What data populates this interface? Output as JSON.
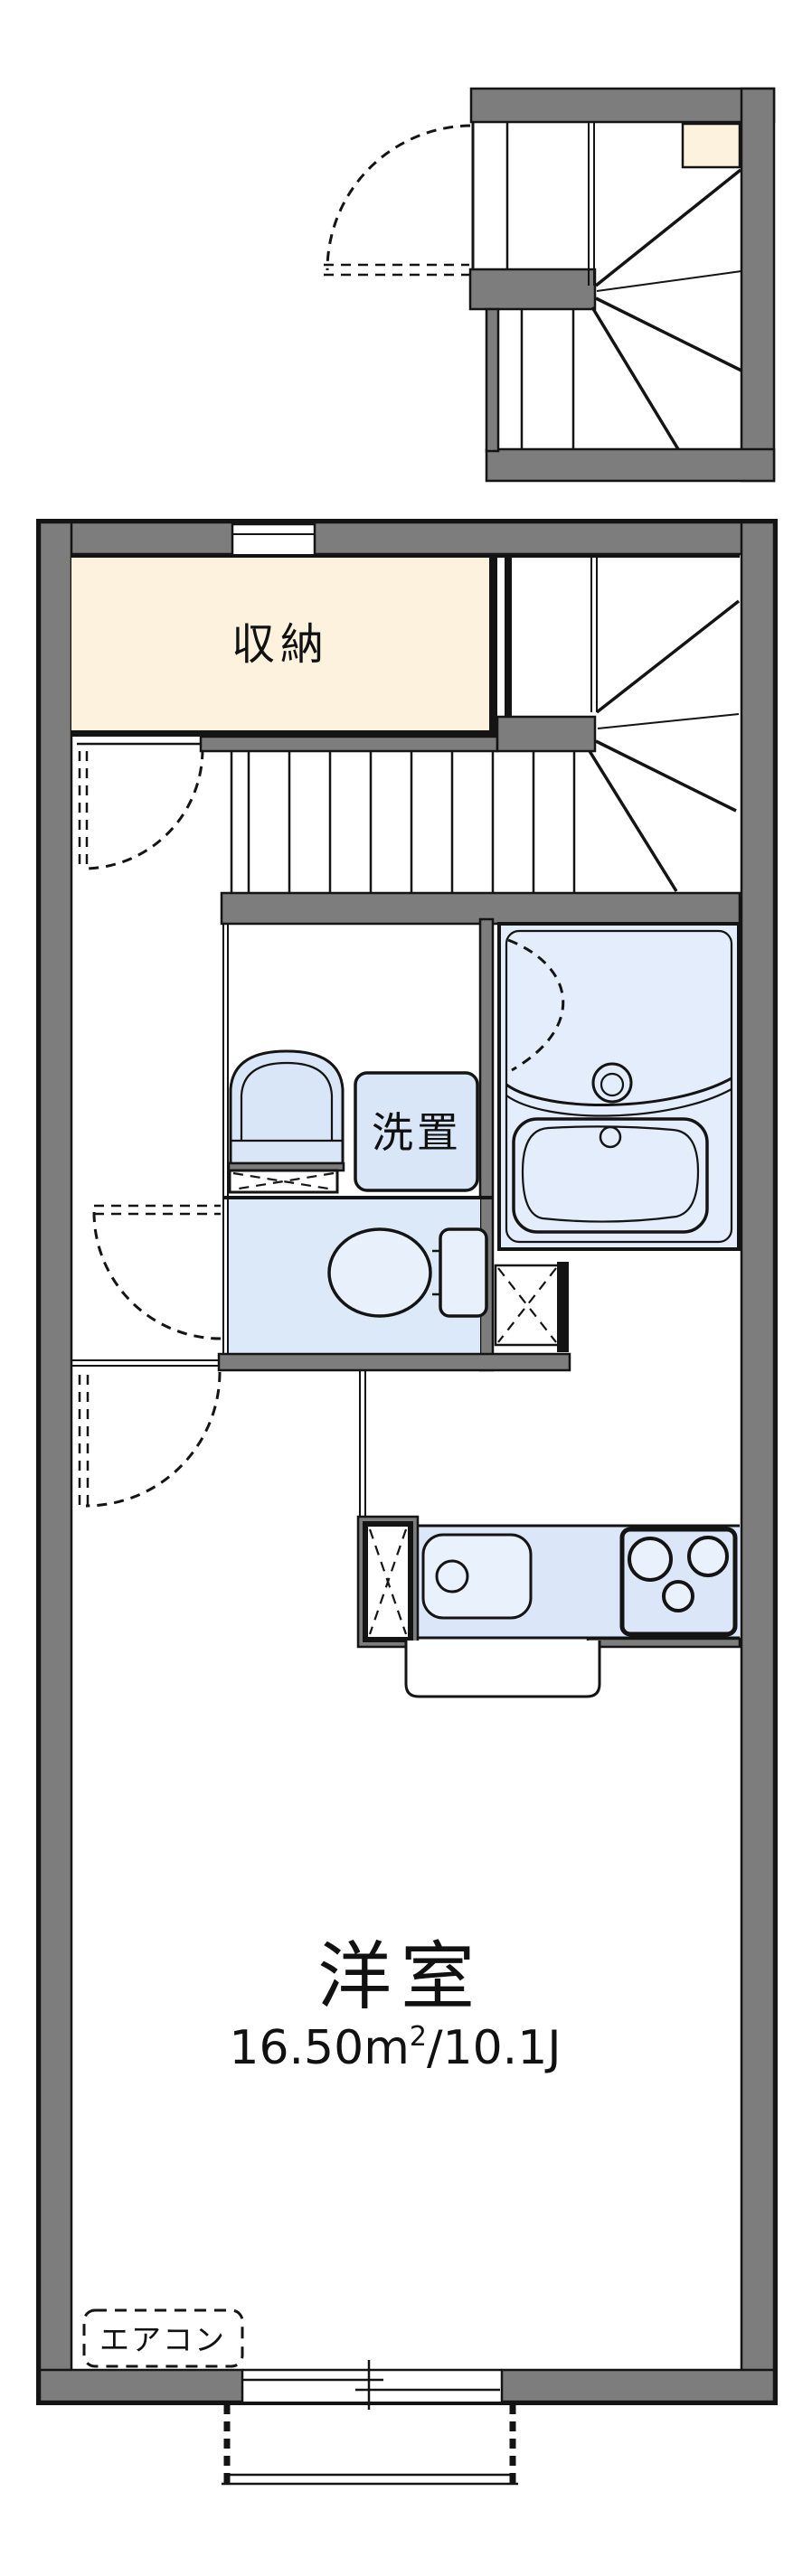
{
  "colors": {
    "background": "#ffffff",
    "wall_gray": "#7d7d7d",
    "line_black": "#141414",
    "closet_cream": "#fdf2dd",
    "fixture_blue": "#d9e6f7",
    "toilet_room_blue": "#dce9f9",
    "bath_blue": "#e3edfb",
    "kitchen_counter_blue": "#dbe7f8",
    "sink_light_blue": "#e9f1fc"
  },
  "labels": {
    "closet": "収納",
    "washer_space": "洗置",
    "main_room": "洋室",
    "aircon": "エアコン"
  },
  "main_room": {
    "area_text": "16.50㎡/10.1J",
    "area_prefix": "16.50m",
    "area_sup": "2",
    "area_suffix": "/10.1J"
  }
}
